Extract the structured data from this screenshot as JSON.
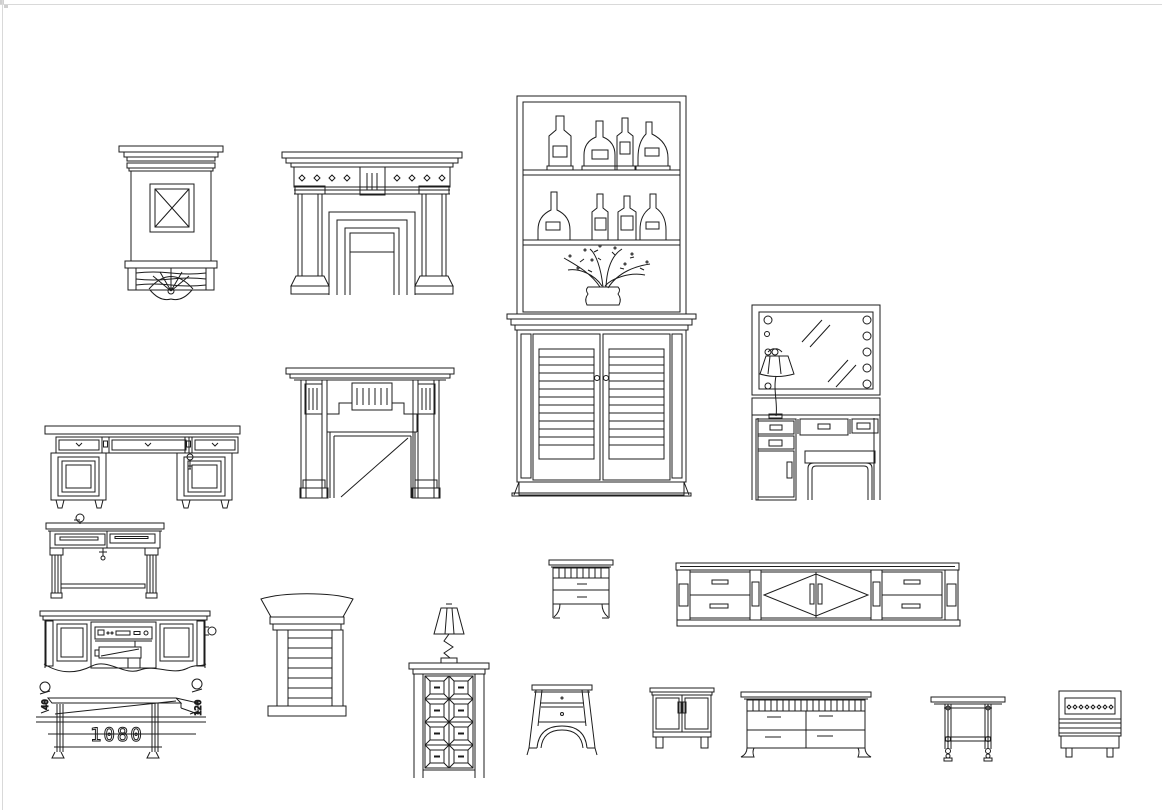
{
  "page": {
    "background": "#ffffff",
    "ink_color": "#1c1c1c",
    "frame_color": "#d9d9d9"
  },
  "annotations": {
    "table_width_dimension": "1080",
    "left_dimension": "40",
    "right_dimension": "120"
  },
  "items": {
    "mantel_cabinet": {
      "label": "Fireplace mantel cabinet with X panel and carved base"
    },
    "fireplace_classic": {
      "label": "Classic fireplace mantel with columns and diamond frieze"
    },
    "bar_display_cabinet": {
      "label": "Tall bar display cabinet with bottles, plant and louvered doors"
    },
    "vanity_mirror": {
      "label": "Vanity dresser with lighted mirror, lamp and stool"
    },
    "writing_desk": {
      "label": "Writing desk with three drawers and pedestal doors"
    },
    "fireplace_stepped": {
      "label": "Fireplace mantel with stepped surround"
    },
    "console_table": {
      "label": "Console table with two dark drawers and fluted legs"
    },
    "media_sideboard": {
      "label": "Media cabinet with stereo equipment, break-line bottom"
    },
    "dimensioned_table": {
      "label": "Table elevation with 1080 width dimension"
    },
    "louvered_pedestal": {
      "label": "Louvered pedestal column with flared capital"
    },
    "panel_chest": {
      "label": "Eight-panel chest with table lamp on top"
    },
    "nightstand_two_drawer": {
      "label": "Two-drawer nightstand with slatted top band"
    },
    "tv_console": {
      "label": "Long TV console with diamond-pattern doors"
    },
    "nightstand_arched": {
      "label": "Nightstand with flared sides and arched apron"
    },
    "two_door_cabinet": {
      "label": "Small two-door cabinet"
    },
    "four_drawer_sideboard": {
      "label": "Four-drawer sideboard with slat band"
    },
    "turned_leg_table": {
      "label": "Side table with turned legs and stretcher"
    },
    "vented_cabinet": {
      "label": "Small cabinet with dotted vent panel"
    }
  }
}
